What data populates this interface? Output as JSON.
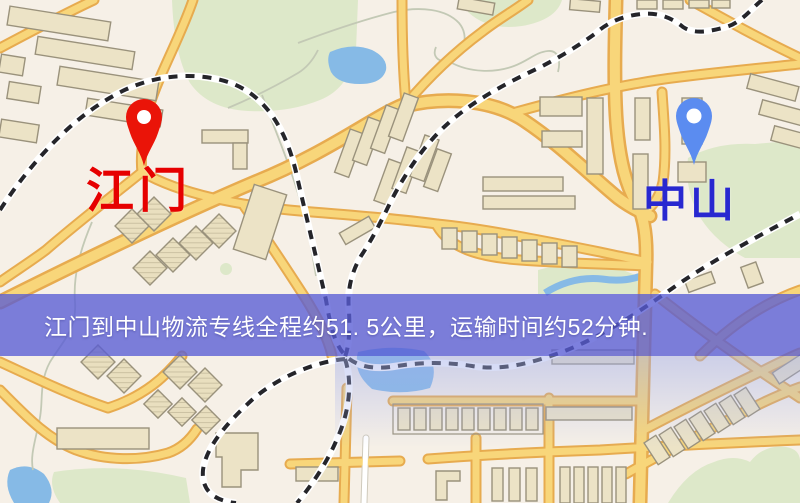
{
  "markers": {
    "origin": {
      "label": "江门",
      "pin_color": "#ea1408",
      "label_color": "#e60000"
    },
    "destination": {
      "label": "中山",
      "pin_color": "#5b8cf0",
      "label_color": "#2828d0"
    }
  },
  "banner": {
    "text": "江门到中山物流专线全程约51. 5公里，运输时间约52分钟.",
    "bg_color": "#585cd5",
    "text_color": "#ffffff"
  },
  "map_palette": {
    "background": "#f6f0e7",
    "road_fill": "#f8d67a",
    "road_casing": "#e7ab4f",
    "park_green": "#dde8c9",
    "water_blue": "#86bae6",
    "building_fill": "#ece3c6",
    "railway_dash": "#25252a"
  },
  "icons": {
    "origin_pin": "red-map-pin-icon",
    "destination_pin": "blue-map-pin-icon"
  }
}
